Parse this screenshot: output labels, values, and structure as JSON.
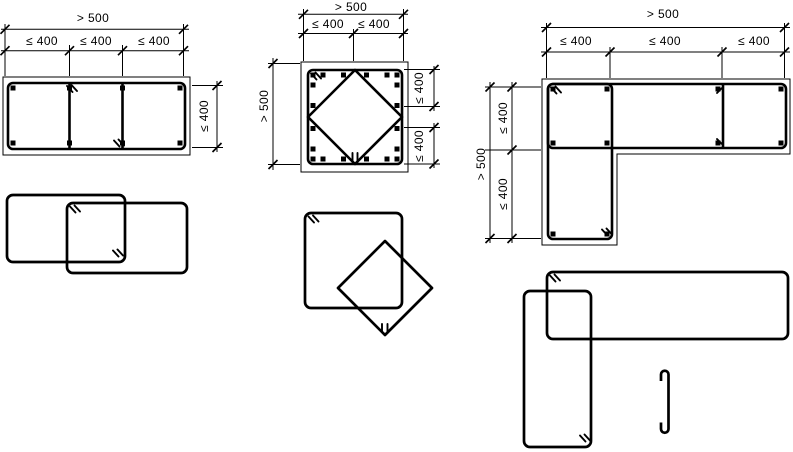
{
  "figure_title": "column-confinement-detailing",
  "colors": {
    "background": "#ffffff",
    "line": "#000000"
  },
  "sections": {
    "rect_column": {
      "top_overall": "> 500",
      "top_segments": [
        "≤ 400",
        "≤ 400",
        "≤ 400"
      ],
      "right_side": "≤ 400"
    },
    "square_column": {
      "top_overall": "> 500",
      "top_segments": [
        "≤ 400",
        "≤ 400"
      ],
      "left_side": "> 500",
      "right_segments": [
        "≤ 400",
        "≤ 400"
      ]
    },
    "l_column": {
      "top_overall": "> 500",
      "top_segments": [
        "≤ 400",
        "≤ 400",
        "≤ 400"
      ],
      "left_overall": "> 500",
      "left_segments": [
        "≤ 400",
        "≤ 400"
      ]
    }
  }
}
